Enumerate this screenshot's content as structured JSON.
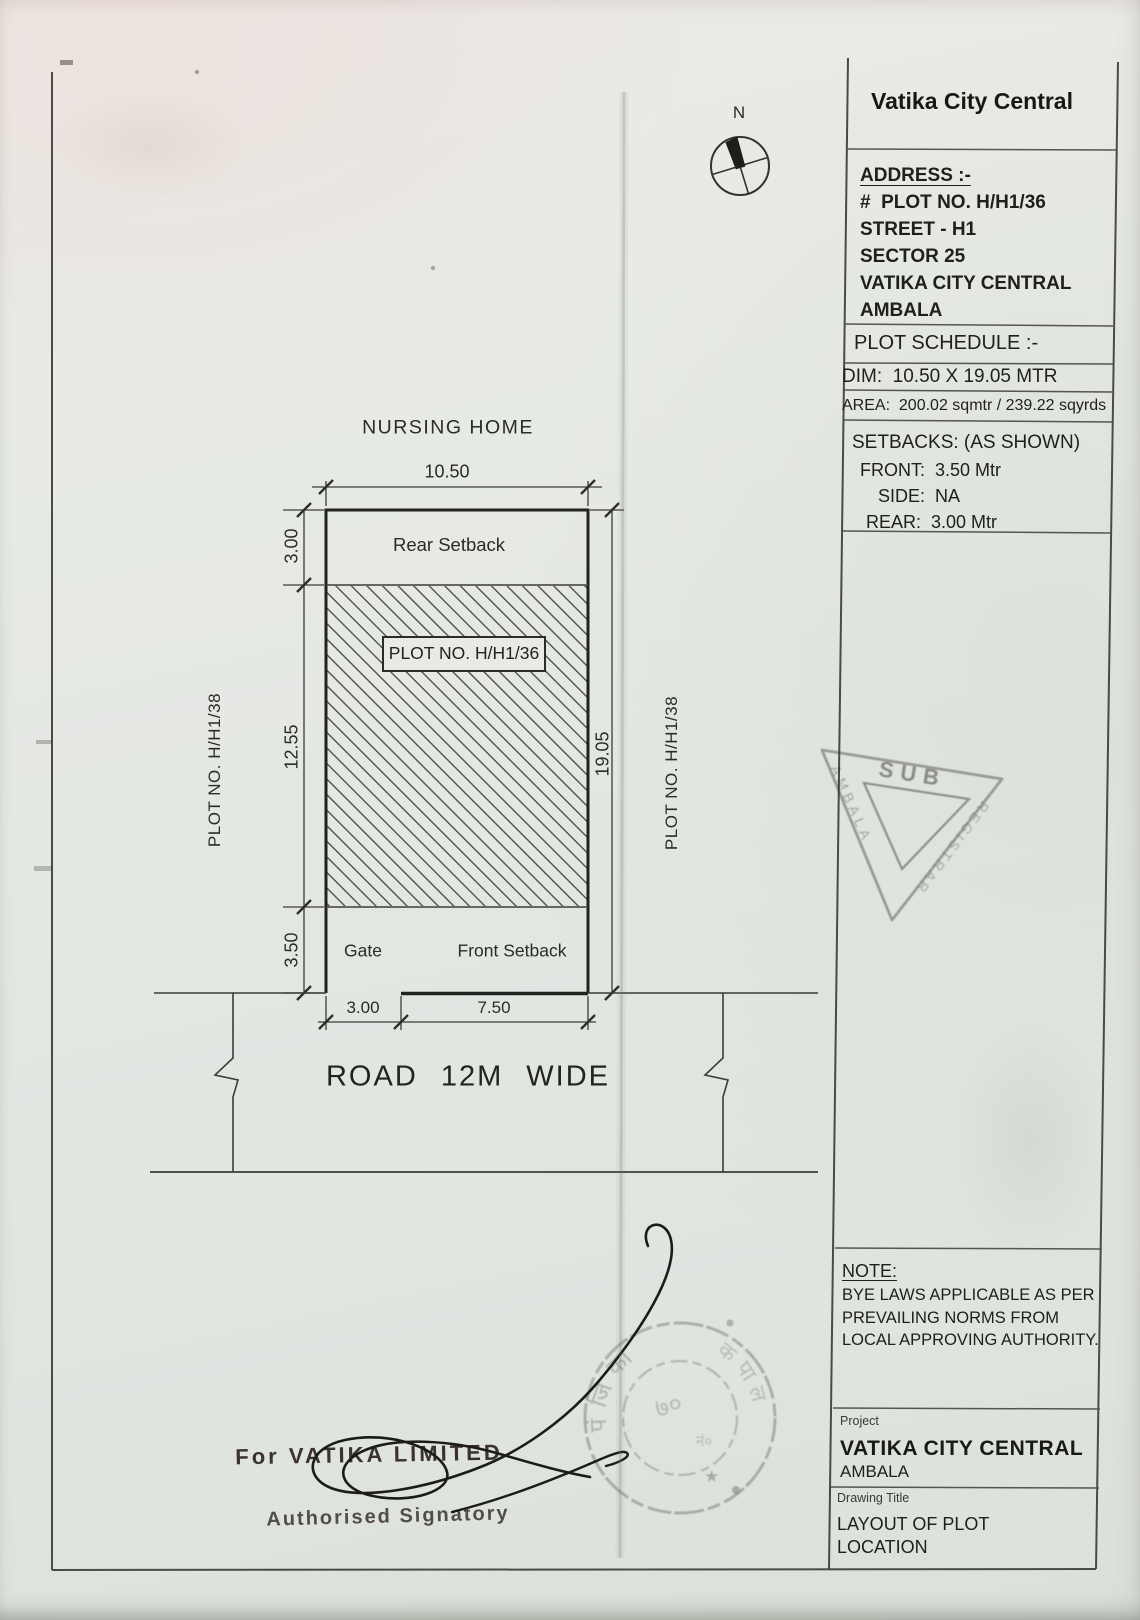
{
  "colors": {
    "ink": "#3a3a38",
    "paper": "#e6e9e4",
    "stamp_ink": "#35322f"
  },
  "title_block": {
    "title": "Vatika City Central",
    "address": {
      "heading": "ADDRESS :-",
      "line1": "#  PLOT NO. H/H1/36",
      "line2": "STREET - H1",
      "line3": "SECTOR 25",
      "line4": "VATIKA CITY CENTRAL",
      "line5": "AMBALA"
    },
    "schedule": {
      "heading": "PLOT SCHEDULE :-",
      "dim": "DIM:  10.50 X 19.05 MTR",
      "area": "AREA:  200.02 sqmtr / 239.22 sqyrds"
    },
    "setbacks": {
      "heading": "SETBACKS: (AS SHOWN)",
      "front": "FRONT:  3.50 Mtr",
      "side": "SIDE:  NA",
      "rear": "REAR:  3.00 Mtr"
    },
    "note": {
      "heading": "NOTE:",
      "line1": "BYE LAWS APPLICABLE AS PER",
      "line2": "PREVAILING NORMS FROM",
      "line3": "LOCAL APPROVING AUTHORITY."
    },
    "project": {
      "label": "Project",
      "name": "VATIKA CITY CENTRAL",
      "city": "AMBALA"
    },
    "drawing_title": {
      "label": "Drawing Title",
      "line1": "LAYOUT OF PLOT",
      "line2": "LOCATION"
    }
  },
  "drawing": {
    "north": "N",
    "top_label": "NURSING HOME",
    "dim_top": "10.50",
    "rear_setback": "Rear Setback",
    "plot_no": "PLOT NO. H/H1/36",
    "dim_rear": "3.00",
    "dim_left": "12.55",
    "dim_front": "3.50",
    "dim_right": "19.05",
    "gate": "Gate",
    "front_setback": "Front Setback",
    "dim_gate": "3.00",
    "dim_front_setback": "7.50",
    "road": "ROAD 12M WIDE",
    "neighbor_left": "PLOT NO. H/H1/38",
    "neighbor_right": "PLOT NO. H/H1/38"
  },
  "signature": {
    "for_line": "For VATIKA LIMITED",
    "role": "Authorised Signatory"
  },
  "stamps": {
    "triangle": {
      "top": "SUB",
      "right": "REGISTRAR",
      "left": "AMBALA"
    },
    "round": {
      "arc_top": "पंजिका",
      "arc_right": "कपाल",
      "num": "७०",
      "reg": "नं०",
      "star": "★"
    }
  }
}
